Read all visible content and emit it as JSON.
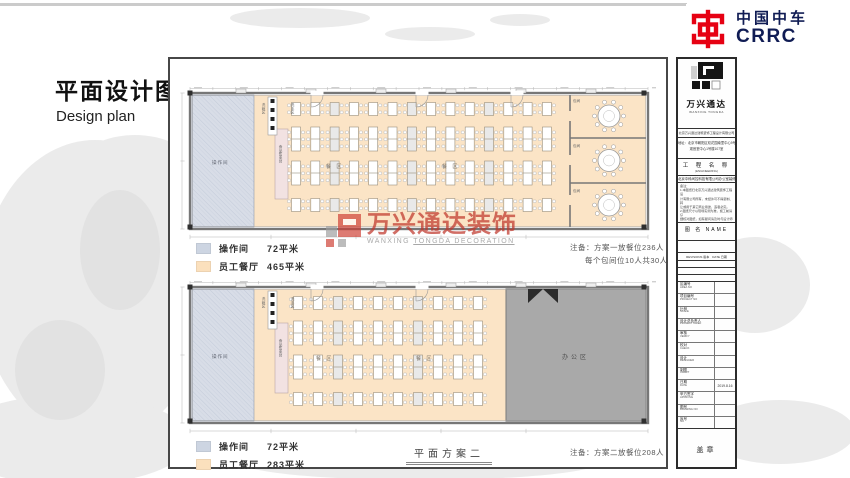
{
  "brand": {
    "name_cn": "中国中车",
    "name_en": "CRRC"
  },
  "page": {
    "title_cn": "平面设计图",
    "title_en": "Design plan"
  },
  "watermark": {
    "cn": "万兴通达装饰",
    "en_1": "WANXING ",
    "en_2": "TONGDA DECORATION"
  },
  "sheet": {
    "plan1": {
      "labels": {
        "operation": "操作间",
        "serving": "食品售卖台",
        "wash_left": "洗碗区",
        "wash_right": "洗手区",
        "dining_a": "餐 区",
        "dining_b": "餐 区",
        "room1": "包间",
        "room2": "包间",
        "room3": "包间"
      },
      "legend": [
        {
          "name": "操作间",
          "area": "72平米",
          "color": "#cdd5e2"
        },
        {
          "name": "员工餐厅",
          "area": "465平米",
          "color": "#fbe0bd"
        }
      ],
      "notes": [
        "注备：方案一放餐位236人",
        "每个包间位10人共30人"
      ]
    },
    "plan2": {
      "labels": {
        "operation": "操作间",
        "serving": "食品售卖台",
        "wash_left": "洗碗区",
        "wash_right": "洗手区",
        "dining_a": "餐 区",
        "dining_b": "餐 区",
        "office": "办公区"
      },
      "legend": [
        {
          "name": "操作间",
          "area": "72平米",
          "color": "#cdd5e2"
        },
        {
          "name": "员工餐厅",
          "area": "283平米",
          "color": "#fbe0bd"
        }
      ],
      "notes": [
        "注备：方案二放餐位208人"
      ],
      "caption": "平面方案二"
    }
  },
  "titleblock": {
    "logo_cn": "万兴通达",
    "logo_en": "WANXING  TONGDA",
    "company": "北京万兴通达建筑装饰工程设计有限公司",
    "address1": "地址：北京市朝阳区双花园南里中心9号",
    "address2": "观音堂中心1号楼107室",
    "project_label_cn": "工 程 名 称",
    "project_label_en": "(ENGINEERING)",
    "project_name": "北京中科间控科技有限公司办公室装修",
    "remarks_label": "备注：",
    "remarks": [
      "1.本图纸归北京万兴通达建筑装饰工程设",
      "计有限公司所有，未经许可不得复制、转",
      "让或用于其它商业用途，违者必究。",
      "2.图纸尺寸以现场实测为准，施工前请仔",
      "细核对图纸，如有疑问请及时与设计师联",
      "系。3.未尽事宜双方协商解决。"
    ],
    "name_row": "图 名  NAME",
    "revisions_row": "REVISIONS 版本　DATE 日期",
    "attrs": [
      {
        "cn": "区编号",
        "en": "AREA NO",
        "value": ""
      },
      {
        "cn": "项目编号",
        "en": "PROJECT NO",
        "value": ""
      },
      {
        "cn": "比例",
        "en": "SCALE",
        "value": ""
      },
      {
        "cn": "设计总负责人",
        "en": "PROJECT CHIEF",
        "value": ""
      },
      {
        "cn": "审核",
        "en": "VERIFY",
        "value": ""
      },
      {
        "cn": "校对",
        "en": "CHECK",
        "value": ""
      },
      {
        "cn": "设计",
        "en": "DESIGNER",
        "value": ""
      },
      {
        "cn": "制图",
        "en": "CHART",
        "value": ""
      },
      {
        "cn": "日期",
        "en": "DATE",
        "value": "2019.8.16"
      },
      {
        "cn": "甲方签字",
        "en": "APPROVE",
        "value": ""
      },
      {
        "cn": "图号",
        "en": "DRAWING NO",
        "value": ""
      },
      {
        "cn": "序号",
        "en": "NO",
        "value": ""
      }
    ],
    "seal": "盖章"
  }
}
